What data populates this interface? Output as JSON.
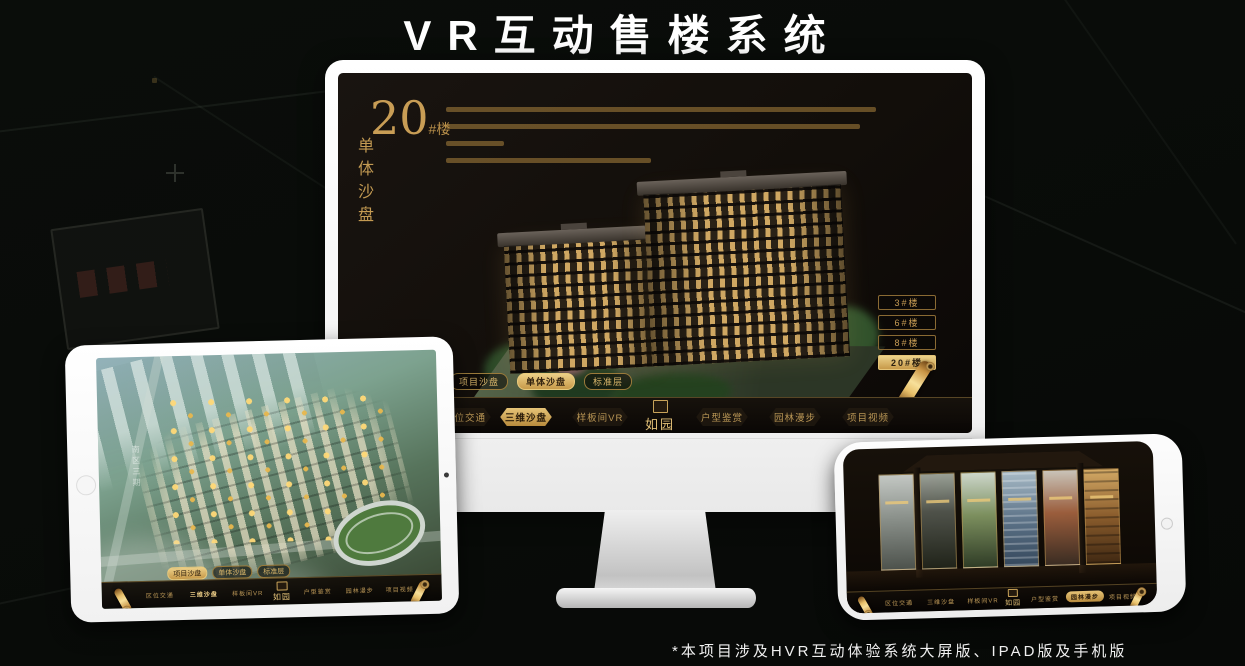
{
  "header": {
    "title": "VR互动售楼系统"
  },
  "footer": {
    "note": "*本项目涉及HVR互动体验系统大屏版、IPAD版及手机版"
  },
  "colors": {
    "gold": "#c89d55",
    "gold_bright": "#ecd28a",
    "screen_bg": "#14100b",
    "white": "#ffffff"
  },
  "icons": {
    "scroll_icon": "gold-scroll",
    "seal_icon": "gold-seal"
  },
  "monitor": {
    "hero": {
      "number": "20",
      "suffix": "#楼",
      "subtitle": "单体沙盘"
    },
    "floor_buttons": [
      {
        "label": "3#楼"
      },
      {
        "label": "6#楼"
      },
      {
        "label": "8#楼"
      },
      {
        "label": "20#楼"
      }
    ],
    "tabs": [
      {
        "label": "项目沙盘"
      },
      {
        "label": "单体沙盘"
      },
      {
        "label": "标准层"
      }
    ],
    "nav": [
      {
        "label": "区位交通"
      },
      {
        "label": "三维沙盘"
      },
      {
        "label": "样板间VR"
      },
      {
        "label": "户型鉴赏"
      },
      {
        "label": "园林漫步"
      },
      {
        "label": "项目视频"
      }
    ],
    "logo": "如园"
  },
  "tablet": {
    "road_label": "南区三期",
    "tabs": [
      {
        "label": "项目沙盘"
      },
      {
        "label": "单体沙盘"
      },
      {
        "label": "标准层"
      }
    ],
    "nav": [
      {
        "label": "区位交通"
      },
      {
        "label": "三维沙盘"
      },
      {
        "label": "样板间VR"
      },
      {
        "label": "户型鉴赏"
      },
      {
        "label": "园林漫步"
      },
      {
        "label": "项目视频"
      }
    ],
    "logo": "如园"
  },
  "phone": {
    "nav": [
      {
        "label": "区位交通"
      },
      {
        "label": "三维沙盘"
      },
      {
        "label": "样板间VR"
      },
      {
        "label": "户型鉴赏"
      },
      {
        "label": "园林漫步"
      },
      {
        "label": "项目视频"
      }
    ],
    "logo": "如园"
  }
}
